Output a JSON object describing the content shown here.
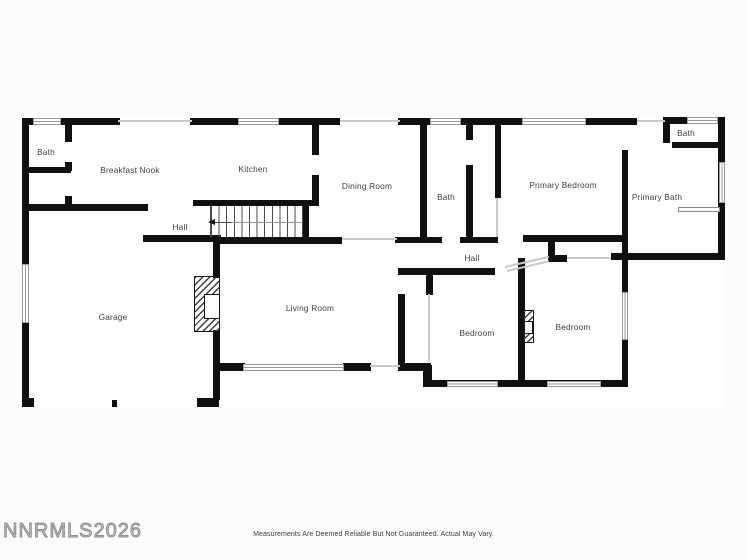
{
  "meta": {
    "width": 747,
    "height": 560
  },
  "colors": {
    "wall": "#101010",
    "faint_line": "#c9c9c9",
    "window_border": "#9a9a9a",
    "label": "#3d3d3d",
    "watermark": "#9b9b9b"
  },
  "footer": {
    "watermark": "NNRMLS2026",
    "disclaimer": "Measurements Are Deemed Reliable But Not Guaranteed. Actual May Vary."
  },
  "rooms": [
    {
      "id": "bath-top-left",
      "label": "Bath",
      "x": 46,
      "y": 152
    },
    {
      "id": "breakfast-nook",
      "label": "Breakfast Nook",
      "x": 130,
      "y": 170
    },
    {
      "id": "kitchen",
      "label": "Kitchen",
      "x": 253,
      "y": 169
    },
    {
      "id": "dining-room",
      "label": "Dining Room",
      "x": 367,
      "y": 186
    },
    {
      "id": "bath-middle",
      "label": "Bath",
      "x": 446,
      "y": 197
    },
    {
      "id": "primary-bedroom",
      "label": "Primary Bedroom",
      "x": 563,
      "y": 185
    },
    {
      "id": "bath-top-right",
      "label": "Bath",
      "x": 686,
      "y": 133
    },
    {
      "id": "primary-bath",
      "label": "Primary Bath",
      "x": 657,
      "y": 197
    },
    {
      "id": "hall-west",
      "label": "Hall",
      "x": 180,
      "y": 227
    },
    {
      "id": "hall-east",
      "label": "Hall",
      "x": 472,
      "y": 258
    },
    {
      "id": "garage",
      "label": "Garage",
      "x": 113,
      "y": 317
    },
    {
      "id": "living-room",
      "label": "Living Room",
      "x": 310,
      "y": 308
    },
    {
      "id": "bedroom-left",
      "label": "Bedroom",
      "x": 477,
      "y": 333
    },
    {
      "id": "bedroom-right",
      "label": "Bedroom",
      "x": 573,
      "y": 327
    }
  ],
  "floor_underlay": [
    22,
    117,
    703,
    291
  ],
  "walls": [
    [
      22,
      118,
      98,
      7
    ],
    [
      190,
      118,
      150,
      7
    ],
    [
      398,
      118,
      239,
      7
    ],
    [
      663,
      117,
      62,
      7
    ],
    [
      22,
      118,
      7,
      289
    ],
    [
      22,
      398,
      12,
      9
    ],
    [
      197,
      398,
      22,
      9
    ],
    [
      65,
      118,
      7,
      24
    ],
    [
      65,
      162,
      7,
      9
    ],
    [
      25,
      167,
      46,
      6
    ],
    [
      65,
      196,
      7,
      12
    ],
    [
      22,
      204,
      126,
      7
    ],
    [
      143,
      235,
      78,
      7
    ],
    [
      193,
      200,
      119,
      6
    ],
    [
      312,
      118,
      7,
      37
    ],
    [
      312,
      175,
      7,
      31
    ],
    [
      302,
      204,
      7,
      33
    ],
    [
      213,
      237,
      129,
      7
    ],
    [
      213,
      238,
      7,
      40
    ],
    [
      213,
      330,
      7,
      70
    ],
    [
      213,
      363,
      32,
      8
    ],
    [
      343,
      363,
      28,
      8
    ],
    [
      398,
      294,
      7,
      71
    ],
    [
      398,
      363,
      33,
      8
    ],
    [
      423,
      365,
      9,
      22
    ],
    [
      395,
      237,
      47,
      6
    ],
    [
      460,
      237,
      38,
      6
    ],
    [
      523,
      235,
      105,
      7
    ],
    [
      548,
      242,
      7,
      16
    ],
    [
      548,
      255,
      19,
      7
    ],
    [
      611,
      253,
      11,
      7
    ],
    [
      627,
      253,
      96,
      7
    ],
    [
      398,
      268,
      97,
      7
    ],
    [
      420,
      123,
      7,
      114
    ],
    [
      466,
      123,
      7,
      17
    ],
    [
      466,
      165,
      7,
      72
    ],
    [
      495,
      123,
      6,
      75
    ],
    [
      622,
      150,
      6,
      92
    ],
    [
      426,
      268,
      7,
      27
    ],
    [
      518,
      258,
      7,
      129
    ],
    [
      425,
      380,
      203,
      7
    ],
    [
      622,
      240,
      6,
      52
    ],
    [
      622,
      340,
      6,
      47
    ],
    [
      663,
      117,
      7,
      26
    ],
    [
      672,
      142,
      51,
      6
    ],
    [
      718,
      117,
      7,
      143
    ]
  ],
  "faint_lines": [
    [
      118,
      120,
      74,
      2,
      0
    ],
    [
      340,
      120,
      60,
      2,
      0
    ],
    [
      637,
      120,
      28,
      2,
      0
    ],
    [
      342,
      238,
      55,
      2,
      0
    ],
    [
      496,
      198,
      2,
      39,
      0
    ],
    [
      428,
      294,
      2,
      68,
      0
    ],
    [
      370,
      365,
      30,
      2,
      0
    ],
    [
      567,
      257,
      44,
      2,
      0
    ],
    [
      505,
      266,
      45,
      2,
      -13
    ],
    [
      507,
      270,
      43,
      2,
      -13
    ]
  ],
  "windows": [
    [
      33,
      118,
      28,
      7
    ],
    [
      238,
      118,
      41,
      7
    ],
    [
      430,
      118,
      31,
      7
    ],
    [
      522,
      118,
      64,
      7
    ],
    [
      687,
      117,
      31,
      7
    ],
    [
      22,
      264,
      7,
      59
    ],
    [
      243,
      364,
      101,
      7
    ],
    [
      447,
      381,
      51,
      6
    ],
    [
      547,
      381,
      54,
      6
    ],
    [
      622,
      292,
      6,
      48
    ],
    [
      719,
      162,
      6,
      41
    ]
  ],
  "stairs": {
    "x": 210,
    "y": 206,
    "w": 93,
    "h": 31,
    "centerline": [
      211,
      222,
      91,
      1
    ],
    "arrow_line": [
      214,
      222,
      18,
      1
    ],
    "arrow_head": [
      208,
      219
    ]
  },
  "fireplaces": [
    {
      "x": 194,
      "y": 276,
      "w": 26,
      "h": 56,
      "inner": [
        204,
        294,
        16,
        25
      ]
    },
    {
      "x": 523,
      "y": 310,
      "w": 11,
      "h": 33,
      "inner": [
        524,
        321,
        9,
        13
      ]
    }
  ],
  "fixtures": [
    [
      678,
      207,
      42,
      5
    ]
  ],
  "garage_door_tick": [
    112,
    400,
    5,
    7
  ]
}
